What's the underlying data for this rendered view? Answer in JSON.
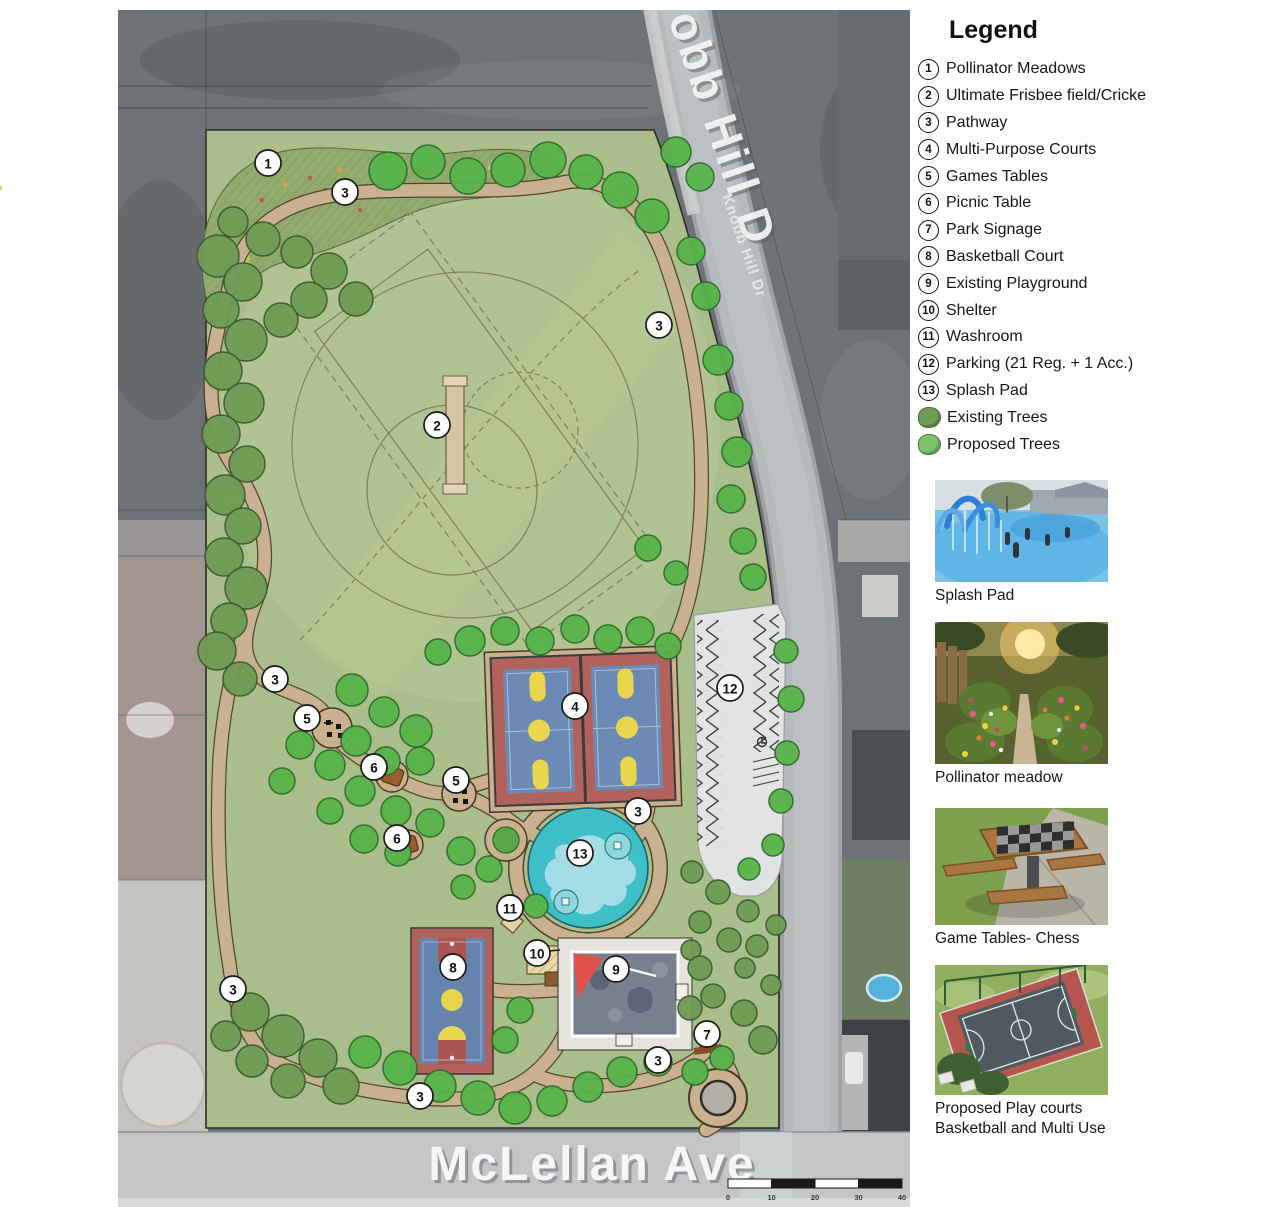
{
  "legend": {
    "title": "Legend",
    "items": [
      {
        "num": "1",
        "label": "Pollinator Meadows"
      },
      {
        "num": "2",
        "label": "Ultimate Frisbee field/Cricke"
      },
      {
        "num": "3",
        "label": "Pathway"
      },
      {
        "num": "4",
        "label": "Multi-Purpose Courts"
      },
      {
        "num": "5",
        "label": "Games Tables"
      },
      {
        "num": "6",
        "label": "Picnic Table"
      },
      {
        "num": "7",
        "label": "Park Signage"
      },
      {
        "num": "8",
        "label": "Basketball Court"
      },
      {
        "num": "9",
        "label": "Existing Playground"
      },
      {
        "num": "10",
        "label": "Shelter"
      },
      {
        "num": "11",
        "label": "Washroom"
      },
      {
        "num": "12",
        "label": "Parking (21 Reg. + 1 Acc.)"
      },
      {
        "num": "13",
        "label": "Splash Pad"
      }
    ],
    "tree_items": [
      {
        "label": "Existing Trees",
        "color": "#6f9c55"
      },
      {
        "label": "Proposed Trees",
        "color": "#7cc36a"
      }
    ]
  },
  "photos": [
    {
      "caption": "Splash Pad"
    },
    {
      "caption": "Pollinator meadow"
    },
    {
      "caption": "Game Tables- Chess"
    },
    {
      "caption": "Proposed Play courts\nBasketball and Multi Use"
    }
  ],
  "map": {
    "street_labels": {
      "knobb_big": "obb Hill D",
      "knobb_small": "Knobb Hill Dr",
      "mclellan": "McLellan Ave"
    },
    "scale_bar": {
      "ticks": [
        "0",
        "10",
        "20",
        "30",
        "40"
      ]
    },
    "markers": [
      {
        "n": "1",
        "x": 268,
        "y": 163
      },
      {
        "n": "3",
        "x": 345,
        "y": 192
      },
      {
        "n": "3",
        "x": 659,
        "y": 325
      },
      {
        "n": "2",
        "x": 437,
        "y": 425
      },
      {
        "n": "3",
        "x": 275,
        "y": 679
      },
      {
        "n": "5",
        "x": 307,
        "y": 718
      },
      {
        "n": "6",
        "x": 374,
        "y": 767
      },
      {
        "n": "5",
        "x": 456,
        "y": 780
      },
      {
        "n": "6",
        "x": 397,
        "y": 838
      },
      {
        "n": "4",
        "x": 575,
        "y": 706
      },
      {
        "n": "12",
        "x": 730,
        "y": 688
      },
      {
        "n": "3",
        "x": 638,
        "y": 811
      },
      {
        "n": "13",
        "x": 580,
        "y": 853
      },
      {
        "n": "11",
        "x": 510,
        "y": 908
      },
      {
        "n": "10",
        "x": 537,
        "y": 953
      },
      {
        "n": "8",
        "x": 453,
        "y": 967
      },
      {
        "n": "9",
        "x": 616,
        "y": 969
      },
      {
        "n": "3",
        "x": 233,
        "y": 989
      },
      {
        "n": "7",
        "x": 707,
        "y": 1034
      },
      {
        "n": "3",
        "x": 658,
        "y": 1060
      },
      {
        "n": "3",
        "x": 420,
        "y": 1096
      }
    ],
    "trees": {
      "existing": [
        [
          218,
          256,
          21
        ],
        [
          243,
          282,
          19
        ],
        [
          221,
          310,
          18
        ],
        [
          246,
          340,
          21
        ],
        [
          223,
          371,
          19
        ],
        [
          244,
          403,
          20
        ],
        [
          221,
          434,
          19
        ],
        [
          247,
          464,
          18
        ],
        [
          225,
          495,
          20
        ],
        [
          243,
          526,
          18
        ],
        [
          224,
          557,
          19
        ],
        [
          246,
          588,
          21
        ],
        [
          229,
          621,
          18
        ],
        [
          217,
          651,
          19
        ],
        [
          240,
          679,
          17
        ],
        [
          233,
          222,
          15
        ],
        [
          263,
          239,
          17
        ],
        [
          297,
          252,
          16
        ],
        [
          329,
          271,
          18
        ],
        [
          356,
          299,
          17
        ],
        [
          309,
          300,
          18
        ],
        [
          281,
          320,
          17
        ],
        [
          250,
          1012,
          19
        ],
        [
          283,
          1036,
          21
        ],
        [
          318,
          1058,
          19
        ],
        [
          288,
          1081,
          17
        ],
        [
          252,
          1061,
          16
        ],
        [
          341,
          1086,
          18
        ],
        [
          226,
          1036,
          15
        ],
        [
          692,
          872,
          11
        ],
        [
          718,
          892,
          12
        ],
        [
          748,
          911,
          11
        ],
        [
          700,
          922,
          11
        ],
        [
          729,
          940,
          12
        ],
        [
          757,
          946,
          11
        ],
        [
          776,
          925,
          10
        ],
        [
          691,
          950,
          10
        ],
        [
          745,
          968,
          10
        ],
        [
          771,
          985,
          10
        ],
        [
          700,
          968,
          12
        ],
        [
          713,
          996,
          12
        ],
        [
          690,
          1008,
          12
        ],
        [
          763,
          1040,
          14
        ],
        [
          744,
          1013,
          13
        ]
      ],
      "proposed": [
        [
          388,
          171,
          19
        ],
        [
          428,
          162,
          17
        ],
        [
          468,
          176,
          18
        ],
        [
          508,
          170,
          17
        ],
        [
          548,
          160,
          18
        ],
        [
          586,
          172,
          17
        ],
        [
          620,
          190,
          18
        ],
        [
          652,
          216,
          17
        ],
        [
          676,
          152,
          15
        ],
        [
          700,
          177,
          14
        ],
        [
          691,
          251,
          14
        ],
        [
          706,
          296,
          14
        ],
        [
          718,
          360,
          15
        ],
        [
          729,
          406,
          14
        ],
        [
          737,
          452,
          15
        ],
        [
          731,
          499,
          14
        ],
        [
          743,
          541,
          13
        ],
        [
          753,
          577,
          13
        ],
        [
          648,
          548,
          13
        ],
        [
          676,
          573,
          12
        ],
        [
          786,
          651,
          12
        ],
        [
          791,
          699,
          13
        ],
        [
          787,
          753,
          12
        ],
        [
          781,
          801,
          12
        ],
        [
          773,
          845,
          11
        ],
        [
          749,
          869,
          11
        ],
        [
          438,
          652,
          13
        ],
        [
          470,
          641,
          15
        ],
        [
          505,
          631,
          14
        ],
        [
          540,
          641,
          14
        ],
        [
          575,
          629,
          14
        ],
        [
          608,
          639,
          14
        ],
        [
          640,
          631,
          14
        ],
        [
          668,
          646,
          13
        ],
        [
          352,
          690,
          16
        ],
        [
          384,
          712,
          15
        ],
        [
          416,
          731,
          16
        ],
        [
          356,
          741,
          15
        ],
        [
          386,
          761,
          14
        ],
        [
          420,
          761,
          14
        ],
        [
          330,
          765,
          15
        ],
        [
          360,
          791,
          15
        ],
        [
          396,
          811,
          15
        ],
        [
          430,
          823,
          14
        ],
        [
          300,
          745,
          14
        ],
        [
          330,
          811,
          13
        ],
        [
          364,
          839,
          14
        ],
        [
          398,
          853,
          13
        ],
        [
          282,
          781,
          13
        ],
        [
          461,
          851,
          14
        ],
        [
          489,
          869,
          13
        ],
        [
          463,
          887,
          12
        ],
        [
          536,
          906,
          12
        ],
        [
          365,
          1052,
          16
        ],
        [
          400,
          1068,
          17
        ],
        [
          440,
          1086,
          16
        ],
        [
          478,
          1098,
          17
        ],
        [
          515,
          1108,
          16
        ],
        [
          552,
          1101,
          15
        ],
        [
          588,
          1087,
          15
        ],
        [
          622,
          1072,
          15
        ],
        [
          658,
          1062,
          14
        ],
        [
          695,
          1072,
          13
        ],
        [
          722,
          1058,
          12
        ],
        [
          520,
          1010,
          13
        ],
        [
          505,
          1040,
          13
        ]
      ]
    }
  },
  "colors": {
    "park_green": "#a9be8a",
    "path_tan": "#c9b190",
    "court_red": "#b2625a",
    "court_blue": "#6b8ab5",
    "marking_yellow": "#ead54e",
    "splash_teal": "#3fbfc7",
    "tree_existing": "#6f9c55",
    "tree_proposed": "#58b44a",
    "parking_gray": "#e2e3e4",
    "road_gray": "#b7babc",
    "aerial_gray": "#6e7175"
  }
}
